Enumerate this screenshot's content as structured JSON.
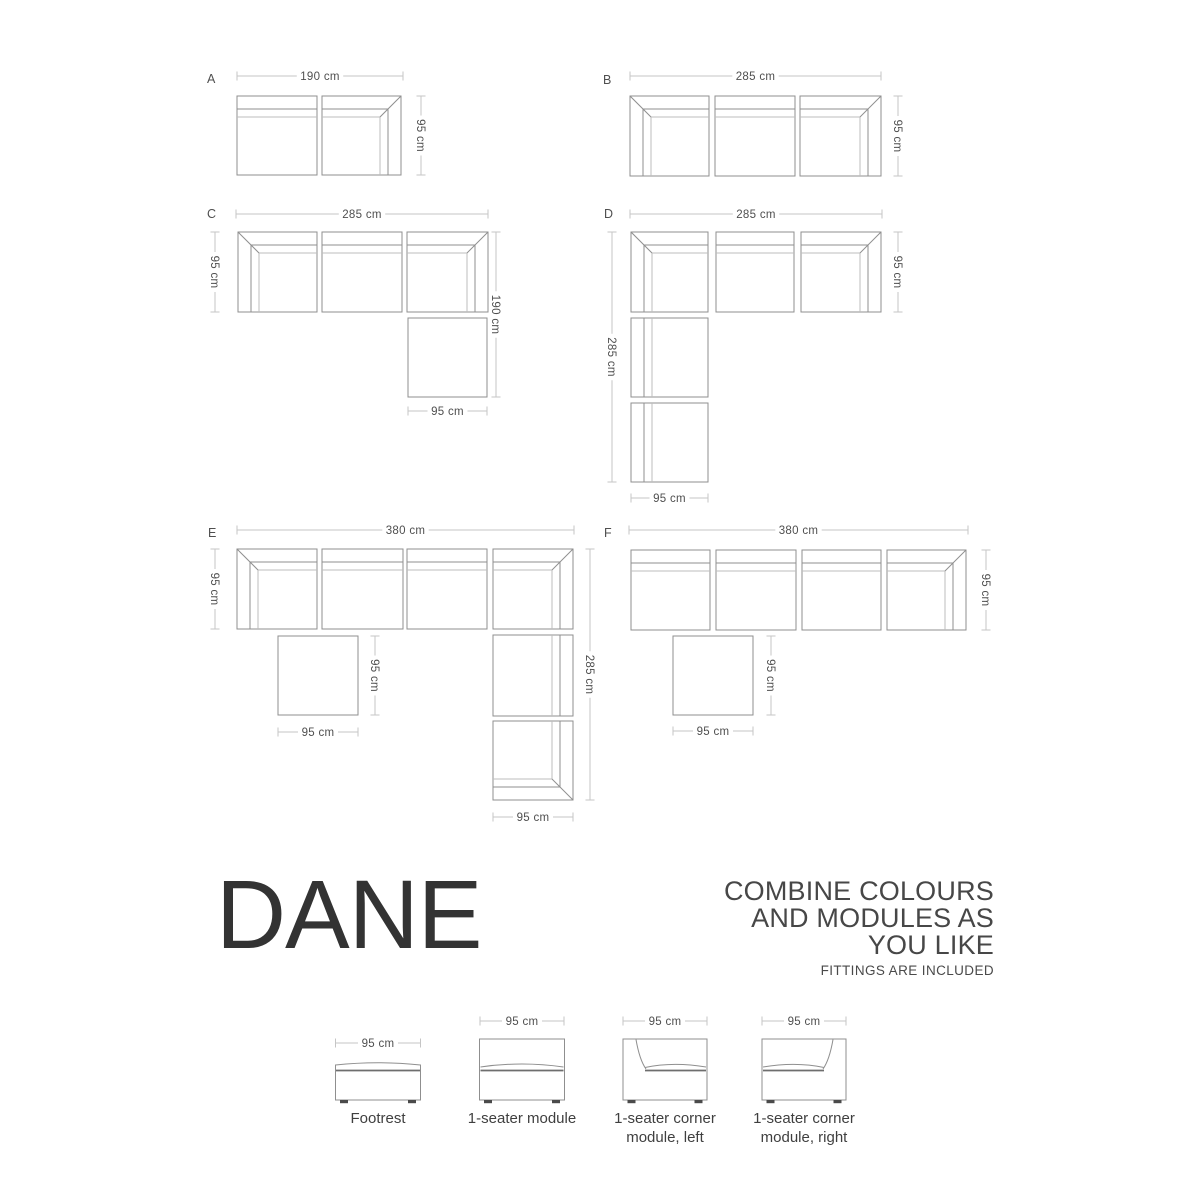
{
  "title": {
    "text": "DANE"
  },
  "tagline": {
    "lines": [
      "COMBINE COLOURS",
      "AND MODULES AS",
      "YOU LIKE"
    ],
    "sub": "FITTINGS ARE INCLUDED"
  },
  "colors": {
    "outline": "#8f8f8f",
    "band_inner": "#bcbcbc",
    "dim_line": "#c5c5c5",
    "dim_text": "#4f4f4f",
    "label_text": "#4f4f4f",
    "seat_line": "#6e6e6e",
    "feet": "#4a4a4a"
  },
  "layouts": [
    {
      "label": "A",
      "lx": 207,
      "ly": 83,
      "modules": [
        {
          "type": "plain-top",
          "x": 237,
          "y": 96,
          "w": 80,
          "h": 79
        },
        {
          "type": "corner-tr",
          "x": 322,
          "y": 96,
          "w": 79,
          "h": 79
        }
      ],
      "dims": [
        {
          "o": "h",
          "x1": 237,
          "x2": 403,
          "y": 76,
          "t": "190 cm"
        },
        {
          "o": "v",
          "y1": 96,
          "y2": 175,
          "x": 421,
          "t": "95 cm"
        }
      ]
    },
    {
      "label": "B",
      "lx": 603,
      "ly": 84,
      "modules": [
        {
          "type": "corner-tl",
          "x": 630,
          "y": 96,
          "w": 79,
          "h": 80
        },
        {
          "type": "plain-top",
          "x": 715,
          "y": 96,
          "w": 80,
          "h": 80
        },
        {
          "type": "corner-tr",
          "x": 800,
          "y": 96,
          "w": 81,
          "h": 80
        }
      ],
      "dims": [
        {
          "o": "h",
          "x1": 630,
          "x2": 881,
          "y": 76,
          "t": "285 cm"
        },
        {
          "o": "v",
          "y1": 96,
          "y2": 176,
          "x": 898,
          "t": "95 cm"
        }
      ]
    },
    {
      "label": "C",
      "lx": 207,
      "ly": 218,
      "modules": [
        {
          "type": "corner-tl",
          "x": 238,
          "y": 232,
          "w": 79,
          "h": 80
        },
        {
          "type": "plain-top",
          "x": 322,
          "y": 232,
          "w": 80,
          "h": 80
        },
        {
          "type": "corner-tr",
          "x": 407,
          "y": 232,
          "w": 81,
          "h": 80
        },
        {
          "type": "footrest",
          "x": 408,
          "y": 318,
          "w": 79,
          "h": 79
        }
      ],
      "dims": [
        {
          "o": "h",
          "x1": 236,
          "x2": 488,
          "y": 214,
          "t": "285 cm"
        },
        {
          "o": "v",
          "y1": 232,
          "y2": 312,
          "x": 215,
          "t": "95 cm"
        },
        {
          "o": "v",
          "y1": 232,
          "y2": 397,
          "x": 496,
          "t": "190 cm"
        },
        {
          "o": "h",
          "x1": 408,
          "x2": 487,
          "y": 411,
          "t": "95 cm"
        }
      ]
    },
    {
      "label": "D",
      "lx": 604,
      "ly": 218,
      "modules": [
        {
          "type": "corner-tl",
          "x": 631,
          "y": 232,
          "w": 77,
          "h": 80
        },
        {
          "type": "plain-top",
          "x": 716,
          "y": 232,
          "w": 78,
          "h": 80
        },
        {
          "type": "corner-tr",
          "x": 801,
          "y": 232,
          "w": 80,
          "h": 80
        },
        {
          "type": "plain-left",
          "x": 631,
          "y": 318,
          "w": 77,
          "h": 79
        },
        {
          "type": "plain-left",
          "x": 631,
          "y": 403,
          "w": 77,
          "h": 79
        }
      ],
      "dims": [
        {
          "o": "h",
          "x1": 630,
          "x2": 882,
          "y": 214,
          "t": "285 cm"
        },
        {
          "o": "v",
          "y1": 232,
          "y2": 482,
          "x": 612,
          "t": "285 cm"
        },
        {
          "o": "v",
          "y1": 232,
          "y2": 312,
          "x": 898,
          "t": "95 cm"
        },
        {
          "o": "h",
          "x1": 631,
          "x2": 708,
          "y": 498,
          "t": "95 cm"
        }
      ]
    },
    {
      "label": "E",
      "lx": 208,
      "ly": 537,
      "modules": [
        {
          "type": "corner-tl",
          "x": 237,
          "y": 549,
          "w": 80,
          "h": 80
        },
        {
          "type": "plain-top",
          "x": 322,
          "y": 549,
          "w": 81,
          "h": 80
        },
        {
          "type": "plain-top",
          "x": 407,
          "y": 549,
          "w": 80,
          "h": 80
        },
        {
          "type": "corner-tr",
          "x": 493,
          "y": 549,
          "w": 80,
          "h": 80
        },
        {
          "type": "footrest",
          "x": 278,
          "y": 636,
          "w": 80,
          "h": 79
        },
        {
          "type": "plain-right",
          "x": 493,
          "y": 635,
          "w": 80,
          "h": 81
        },
        {
          "type": "corner-rb",
          "x": 493,
          "y": 721,
          "w": 80,
          "h": 79
        }
      ],
      "dims": [
        {
          "o": "h",
          "x1": 237,
          "x2": 574,
          "y": 530,
          "t": "380 cm"
        },
        {
          "o": "v",
          "y1": 549,
          "y2": 629,
          "x": 215,
          "t": "95 cm"
        },
        {
          "o": "v",
          "y1": 636,
          "y2": 715,
          "x": 375,
          "t": "95 cm"
        },
        {
          "o": "h",
          "x1": 278,
          "x2": 358,
          "y": 732,
          "t": "95 cm"
        },
        {
          "o": "v",
          "y1": 549,
          "y2": 800,
          "x": 590,
          "t": "285 cm"
        },
        {
          "o": "h",
          "x1": 493,
          "x2": 573,
          "y": 817,
          "t": "95 cm"
        }
      ]
    },
    {
      "label": "F",
      "lx": 604,
      "ly": 537,
      "modules": [
        {
          "type": "plain-top",
          "x": 631,
          "y": 550,
          "w": 79,
          "h": 80
        },
        {
          "type": "plain-top",
          "x": 716,
          "y": 550,
          "w": 80,
          "h": 80
        },
        {
          "type": "plain-top",
          "x": 802,
          "y": 550,
          "w": 79,
          "h": 80
        },
        {
          "type": "corner-tr",
          "x": 887,
          "y": 550,
          "w": 79,
          "h": 80
        },
        {
          "type": "footrest",
          "x": 673,
          "y": 636,
          "w": 80,
          "h": 79
        }
      ],
      "dims": [
        {
          "o": "h",
          "x1": 629,
          "x2": 968,
          "y": 530,
          "t": "380 cm"
        },
        {
          "o": "v",
          "y1": 636,
          "y2": 715,
          "x": 771,
          "t": "95 cm"
        },
        {
          "o": "h",
          "x1": 673,
          "x2": 753,
          "y": 731,
          "t": "95 cm"
        },
        {
          "o": "v",
          "y1": 550,
          "y2": 630,
          "x": 986,
          "t": "95 cm"
        }
      ]
    }
  ],
  "legend": {
    "items": [
      {
        "icon": "footrest",
        "dim": "95 cm",
        "cx": 378,
        "dim_y": 1043,
        "lines": [
          "Footrest"
        ]
      },
      {
        "icon": "seater",
        "dim": "95 cm",
        "cx": 522,
        "dim_y": 1021,
        "lines": [
          "1-seater module"
        ]
      },
      {
        "icon": "corner-left",
        "dim": "95 cm",
        "cx": 665,
        "dim_y": 1021,
        "lines": [
          "1-seater corner",
          "module, left"
        ]
      },
      {
        "icon": "corner-right",
        "dim": "95 cm",
        "cx": 804,
        "dim_y": 1021,
        "lines": [
          "1-seater corner",
          "module, right"
        ]
      }
    ]
  }
}
